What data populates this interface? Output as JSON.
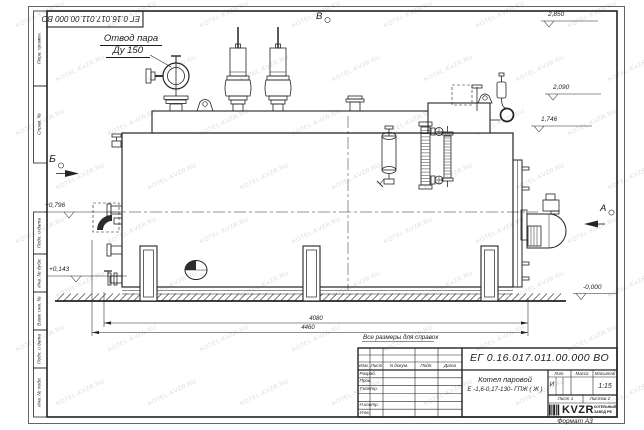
{
  "watermark": {
    "text": "KOTEL-KVZR.RU"
  },
  "frame": {
    "stamp_top": "ЕГ 0.16.017.011.00.000  ВО",
    "side_labels": [
      "Перв. примен.",
      "Справ. №",
      "Подп. и дата",
      "Инв. № дубл.",
      "Взам. инв. №",
      "Подп. и дата",
      "Инв. № подл."
    ],
    "format_note": "Формат А3"
  },
  "annotations": {
    "steam_outlet_line1": "Отвод пара",
    "steam_outlet_line2": "Ду 150",
    "view_b": "Б",
    "view_v": "В",
    "view_a": "А",
    "elev_2850": "2,850",
    "elev_2090": "2,090",
    "elev_1746": "1,746",
    "elev_0796": "+0,796",
    "elev_0143": "+0,143",
    "elev_0000": "-0,000",
    "dim_4080": "4080",
    "dim_4460": "4460",
    "ref_note": "Все размеры для справок"
  },
  "title_block": {
    "doc_number": "ЕГ 0.16.017.011.00.000  ВО",
    "col_izm": "Изм.",
    "col_list": "Лист",
    "col_ndoc": "N докум.",
    "col_podp": "Подп.",
    "col_data": "Дата",
    "row_razrab": "Разраб.",
    "row_prov": "Пров.",
    "row_tkontr": "Т.контр.",
    "row_nkontr": "Н.контр.",
    "row_utv": "Утв.",
    "product_name": "Котел паровой",
    "product_type": "Е -1,6-0,17-130- ГПЖ ( Ж )",
    "lit_header": "Лит.",
    "mass_header": "Масса",
    "scale_header": "Масштаб",
    "lit_value": "И",
    "scale_value": "1:15",
    "sheet": "Лист 1",
    "sheets": "Листов 2",
    "logo_text": "KVZR",
    "logo_sub1": "КОТЕЛЬНЫЙ",
    "logo_sub2": "ЗАВОД РФ"
  }
}
